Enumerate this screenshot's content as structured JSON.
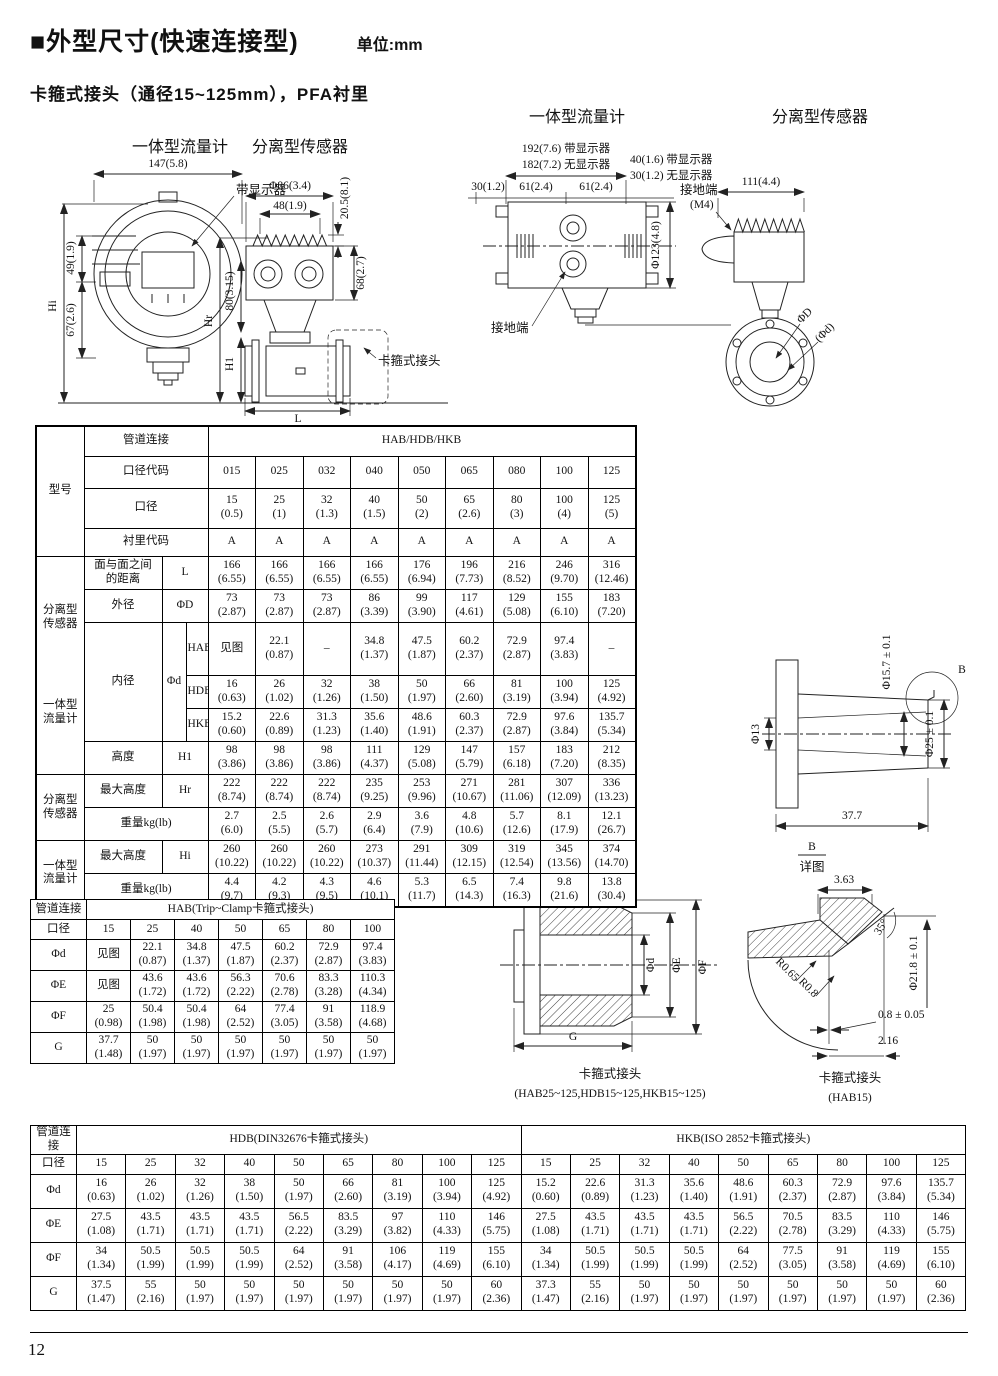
{
  "page": {
    "title": "■外型尺寸(快速连接型)",
    "unit": "单位:mm",
    "subtitle": "卡箍式接头（通径15~125mm），PFA衬里",
    "number": "12"
  },
  "drawings": {
    "top_left": {
      "title_integral": "一体型流量计",
      "title_separate": "分离型传感器",
      "dim_147": "147(5.8)",
      "label_display": "带显示器",
      "dim_phi86": "Φ86(3.4)",
      "dim_48": "48(1.9)",
      "dim_205": "20.5(8.1)",
      "dim_49": "49(1.9)",
      "dim_67": "67(2.6)",
      "dim_hi": "Hi",
      "dim_80": "80(3.15)",
      "dim_hr": "Hr",
      "dim_h1": "H1",
      "dim_68": "68(2.7)",
      "dim_l": "L",
      "label_clamp": "卡箍式接头"
    },
    "top_right": {
      "title_integral": "一体型流量计",
      "title_separate": "分离型传感器",
      "dim_192": "192(7.6) 带显示器",
      "dim_182": "182(7.2) 无显示器",
      "dim_30": "30(1.2)",
      "dim_61a": "61(2.4)",
      "dim_61b": "61(2.4)",
      "dim_40": "40(1.6) 带显示器",
      "dim_30b": "30(1.2) 无显示器",
      "dim_phi123": "Φ123(4.8)",
      "label_ground": "接地端",
      "label_ground_m4": "接地端",
      "label_m4": "(M4)",
      "dim_111": "111(4.4)",
      "label_phiD": "ΦD",
      "label_phid": "(Φd)"
    },
    "side_view": {
      "dim_phi13": "Φ13",
      "dim_phi157": "Φ15.7 ± 0.1",
      "dim_phi25": "Φ25 ± 0.1",
      "dim_377": "37.7",
      "balloon_b": "B",
      "detail_b": "B",
      "detail_word": "详图"
    },
    "detail_b": {
      "dim_363": "3.63",
      "dim_35deg": "35°",
      "dim_phi218": "Φ21.8 ± 0.1",
      "dim_r065": "R0.65",
      "dim_r08": "R0.8",
      "dim_08": "0.8 ± 0.05",
      "dim_216": "2.16",
      "caption1": "卡箍式接头",
      "caption2": "(HAB15)"
    },
    "clamp_section": {
      "label_phid": "Φd",
      "label_phiE": "ΦE",
      "label_phiF": "ΦF",
      "label_g": "G",
      "caption1": "卡箍式接头",
      "caption2": "(HAB25~125,HDB15~125,HKB15~125)"
    }
  },
  "main_table": {
    "model": "型号",
    "pipe_label": "管道连接",
    "pipe_value": "HAB/HDB/HKB",
    "code_label": "口径代码",
    "codes": [
      "015",
      "025",
      "032",
      "040",
      "050",
      "065",
      "080",
      "100",
      "125"
    ],
    "size_label": "口径",
    "sizes": [
      "15\n(0.5)",
      "25\n(1)",
      "32\n(1.3)",
      "40\n(1.5)",
      "50\n(2)",
      "65\n(2.6)",
      "80\n(3)",
      "100\n(4)",
      "125\n(5)"
    ],
    "liner_label": "衬里代码",
    "liners": [
      "A",
      "A",
      "A",
      "A",
      "A",
      "A",
      "A",
      "A",
      "A"
    ],
    "group_sep": "分离型\n传感器",
    "group_int": "一体型\n流量计",
    "bore_label": "内径",
    "bore_sym": "Φd",
    "rows": {
      "L": {
        "label": "面与面之间\n的距离",
        "sym": "L",
        "v": [
          "166\n(6.55)",
          "166\n(6.55)",
          "166\n(6.55)",
          "166\n(6.55)",
          "176\n(6.94)",
          "196\n(7.73)",
          "216\n(8.52)",
          "246\n(9.70)",
          "316\n(12.46)"
        ]
      },
      "D": {
        "label": "外径",
        "sym": "ΦD",
        "v": [
          "73\n(2.87)",
          "73\n(2.87)",
          "73\n(2.87)",
          "86\n(3.39)",
          "99\n(3.90)",
          "117\n(4.61)",
          "129\n(5.08)",
          "155\n(6.10)",
          "183\n(7.20)"
        ]
      },
      "HAB": {
        "sub": "HAB",
        "v": [
          "见图",
          "22.1\n(0.87)",
          "–",
          "34.8\n(1.37)",
          "47.5\n(1.87)",
          "60.2\n(2.37)",
          "72.9\n(2.87)",
          "97.4\n(3.83)",
          "–"
        ]
      },
      "HDB": {
        "sub": "HDB",
        "v": [
          "16\n(0.63)",
          "26\n(1.02)",
          "32\n(1.26)",
          "38\n(1.50)",
          "50\n(1.97)",
          "66\n(2.60)",
          "81\n(3.19)",
          "100\n(3.94)",
          "125\n(4.92)"
        ]
      },
      "HKB": {
        "sub": "HKB",
        "v": [
          "15.2\n(0.60)",
          "22.6\n(0.89)",
          "31.3\n(1.23)",
          "35.6\n(1.40)",
          "48.6\n(1.91)",
          "60.3\n(2.37)",
          "72.9\n(2.87)",
          "97.6\n(3.84)",
          "135.7\n(5.34)"
        ]
      },
      "H1": {
        "label": "高度",
        "sym": "H1",
        "v": [
          "98\n(3.86)",
          "98\n(3.86)",
          "98\n(3.86)",
          "111\n(4.37)",
          "129\n(5.08)",
          "147\n(5.79)",
          "157\n(6.18)",
          "183\n(7.20)",
          "212\n(8.35)"
        ]
      },
      "Hr": {
        "group": "分离型\n传感器",
        "label": "最大高度",
        "sym": "Hr",
        "v": [
          "222\n(8.74)",
          "222\n(8.74)",
          "222\n(8.74)",
          "235\n(9.25)",
          "253\n(9.96)",
          "271\n(10.67)",
          "281\n(11.06)",
          "307\n(12.09)",
          "336\n(13.23)"
        ]
      },
      "Wr": {
        "label": "重量kg(lb)",
        "v": [
          "2.7\n(6.0)",
          "2.5\n(5.5)",
          "2.6\n(5.7)",
          "2.9\n(6.4)",
          "3.6\n(7.9)",
          "4.8\n(10.6)",
          "5.7\n(12.6)",
          "8.1\n(17.9)",
          "12.1\n(26.7)"
        ]
      },
      "Hi": {
        "group": "一体型\n流量计",
        "label": "最大高度",
        "sym": "Hi",
        "v": [
          "260\n(10.22)",
          "260\n(10.22)",
          "260\n(10.22)",
          "273\n(10.37)",
          "291\n(11.44)",
          "309\n(12.15)",
          "319\n(12.54)",
          "345\n(13.56)",
          "374\n(14.70)"
        ]
      },
      "Wi": {
        "label": "重量kg(lb)",
        "v": [
          "4.4\n(9.7)",
          "4.2\n(9.3)",
          "4.3\n(9.5)",
          "4.6\n(10.1)",
          "5.3\n(11.7)",
          "6.5\n(14.3)",
          "7.4\n(16.3)",
          "9.8\n(21.6)",
          "13.8\n(30.4)"
        ]
      }
    }
  },
  "hab_table": {
    "pipe_label": "管道连接",
    "title": "HAB(Trip~Clamp卡箍式接头)",
    "size_label": "口径",
    "sizes": [
      "15",
      "25",
      "40",
      "50",
      "65",
      "80",
      "100"
    ],
    "rows": [
      {
        "label": "Φd",
        "v": [
          "见图",
          "22.1\n(0.87)",
          "34.8\n(1.37)",
          "47.5\n(1.87)",
          "60.2\n(2.37)",
          "72.9\n(2.87)",
          "97.4\n(3.83)"
        ]
      },
      {
        "label": "ΦE",
        "v": [
          "见图",
          "43.6\n(1.72)",
          "43.6\n(1.72)",
          "56.3\n(2.22)",
          "70.6\n(2.78)",
          "83.3\n(3.28)",
          "110.3\n(4.34)"
        ]
      },
      {
        "label": "ΦF",
        "v": [
          "25\n(0.98)",
          "50.4\n(1.98)",
          "50.4\n(1.98)",
          "64\n(2.52)",
          "77.4\n(3.05)",
          "91\n(3.58)",
          "118.9\n(4.68)"
        ]
      },
      {
        "label": "G",
        "v": [
          "37.7\n(1.48)",
          "50\n(1.97)",
          "50\n(1.97)",
          "50\n(1.97)",
          "50\n(1.97)",
          "50\n(1.97)",
          "50\n(1.97)"
        ]
      }
    ]
  },
  "bottom_table": {
    "pipe_label": "管道连接",
    "hdb_title": "HDB(DIN32676卡箍式接头)",
    "hkb_title": "HKB(ISO 2852卡箍式接头)",
    "size_label": "口径",
    "hdb_sizes": [
      "15",
      "25",
      "32",
      "40",
      "50",
      "65",
      "80",
      "100",
      "125"
    ],
    "hkb_sizes": [
      "15",
      "25",
      "32",
      "40",
      "50",
      "65",
      "80",
      "100",
      "125"
    ],
    "rows": [
      {
        "label": "Φd",
        "hdb": [
          "16\n(0.63)",
          "26\n(1.02)",
          "32\n(1.26)",
          "38\n(1.50)",
          "50\n(1.97)",
          "66\n(2.60)",
          "81\n(3.19)",
          "100\n(3.94)",
          "125\n(4.92)"
        ],
        "hkb": [
          "15.2\n(0.60)",
          "22.6\n(0.89)",
          "31.3\n(1.23)",
          "35.6\n(1.40)",
          "48.6\n(1.91)",
          "60.3\n(2.37)",
          "72.9\n(2.87)",
          "97.6\n(3.84)",
          "135.7\n(5.34)"
        ]
      },
      {
        "label": "ΦE",
        "hdb": [
          "27.5\n(1.08)",
          "43.5\n(1.71)",
          "43.5\n(1.71)",
          "43.5\n(1.71)",
          "56.5\n(2.22)",
          "83.5\n(3.29)",
          "97\n(3.82)",
          "110\n(4.33)",
          "146\n(5.75)"
        ],
        "hkb": [
          "27.5\n(1.08)",
          "43.5\n(1.71)",
          "43.5\n(1.71)",
          "43.5\n(1.71)",
          "56.5\n(2.22)",
          "70.5\n(2.78)",
          "83.5\n(3.29)",
          "110\n(4.33)",
          "146\n(5.75)"
        ]
      },
      {
        "label": "ΦF",
        "hdb": [
          "34\n(1.34)",
          "50.5\n(1.99)",
          "50.5\n(1.99)",
          "50.5\n(1.99)",
          "64\n(2.52)",
          "91\n(3.58)",
          "106\n(4.17)",
          "119\n(4.69)",
          "155\n(6.10)"
        ],
        "hkb": [
          "34\n(1.34)",
          "50.5\n(1.99)",
          "50.5\n(1.99)",
          "50.5\n(1.99)",
          "64\n(2.52)",
          "77.5\n(3.05)",
          "91\n(3.58)",
          "119\n(4.69)",
          "155\n(6.10)"
        ]
      },
      {
        "label": "G",
        "hdb": [
          "37.5\n(1.47)",
          "55\n(2.16)",
          "50\n(1.97)",
          "50\n(1.97)",
          "50\n(1.97)",
          "50\n(1.97)",
          "50\n(1.97)",
          "50\n(1.97)",
          "60\n(2.36)"
        ],
        "hkb": [
          "37.3\n(1.47)",
          "55\n(2.16)",
          "50\n(1.97)",
          "50\n(1.97)",
          "50\n(1.97)",
          "50\n(1.97)",
          "50\n(1.97)",
          "50\n(1.97)",
          "60\n(2.36)"
        ]
      }
    ]
  }
}
